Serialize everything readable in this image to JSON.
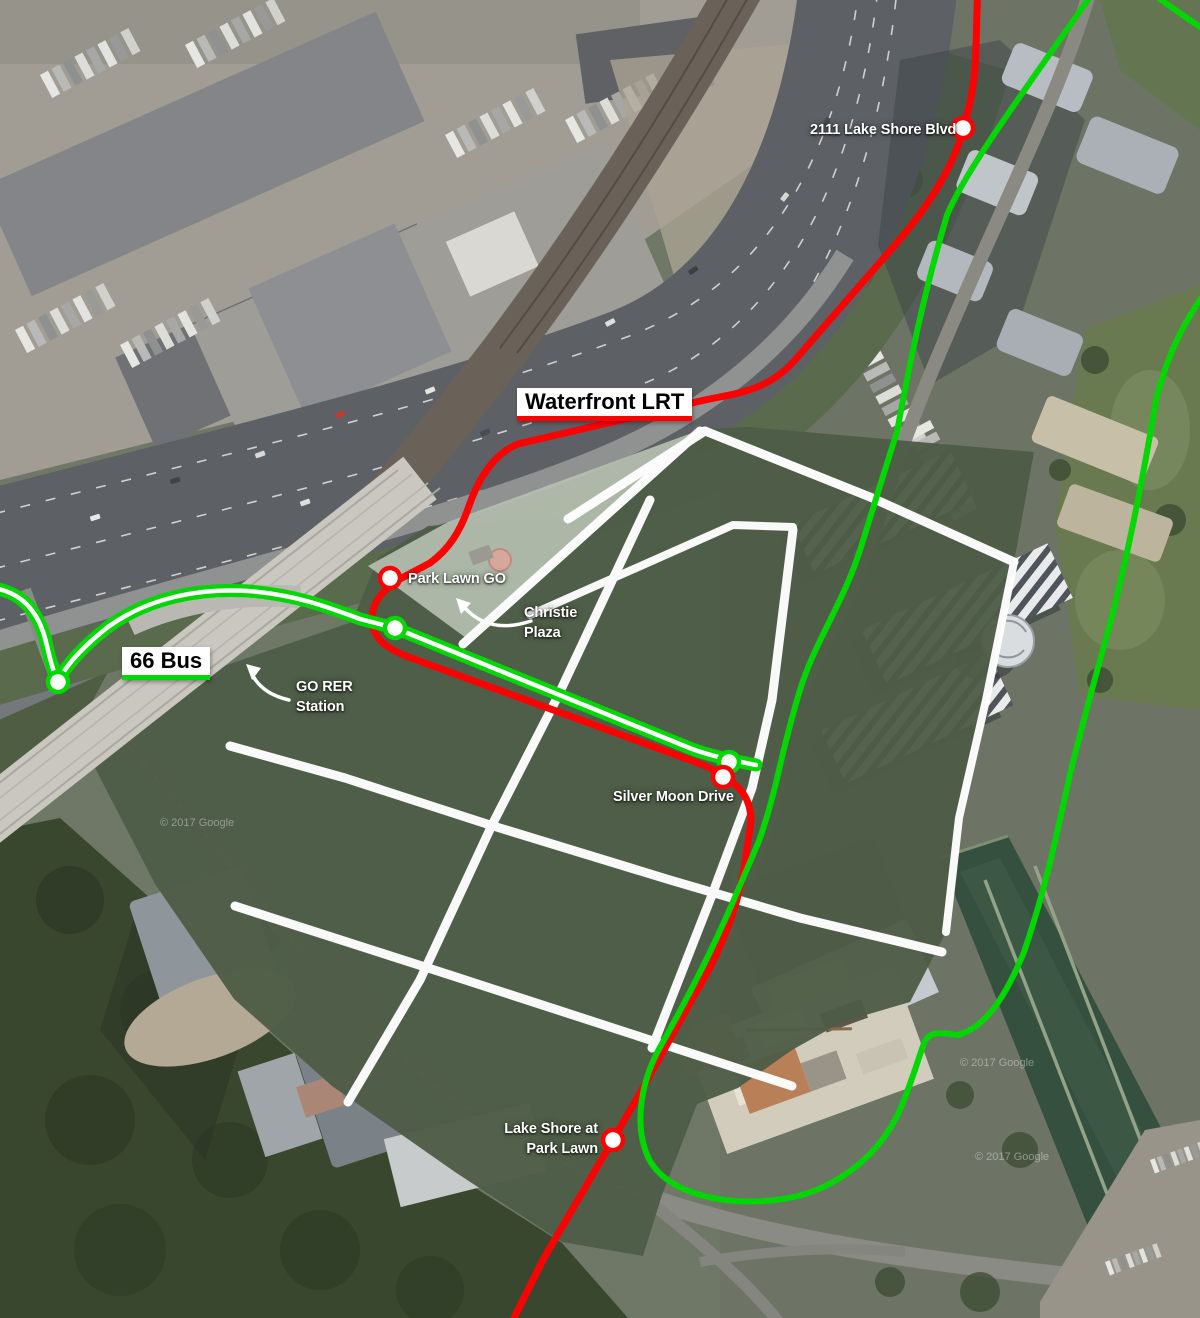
{
  "map": {
    "routes": [
      {
        "id": "waterfront-lrt",
        "label": "Waterfront LRT",
        "mode": "LRT",
        "color": "#FF0000"
      },
      {
        "id": "66-bus",
        "label": "66 Bus",
        "mode": "Bus",
        "color": "#00D600"
      }
    ],
    "stations": [
      {
        "id": "2111-lake-shore-blvd",
        "label": "2111 Lake Shore Blvd",
        "route": "waterfront-lrt"
      },
      {
        "id": "park-lawn-go",
        "label": "Park Lawn GO",
        "route": "waterfront-lrt"
      },
      {
        "id": "silver-moon-drive",
        "label": "Silver Moon Drive",
        "route": "waterfront-lrt"
      },
      {
        "id": "lake-shore-at-park-lawn",
        "line1": "Lake Shore at",
        "line2": "Park Lawn",
        "route": "waterfront-lrt"
      }
    ],
    "places": [
      {
        "id": "christie-plaza",
        "line1": "Christie",
        "line2": "Plaza"
      },
      {
        "id": "go-rer-station",
        "line1": "GO RER",
        "line2": "Station"
      }
    ],
    "colors": {
      "lrt_red": "#FF0000",
      "bus_green": "#00D600",
      "parcel_green": "#4E5D47",
      "plaza_overlay": "#B7C1B1",
      "street_white": "#FFFFFF"
    },
    "watermark": "© 2017 Google"
  }
}
